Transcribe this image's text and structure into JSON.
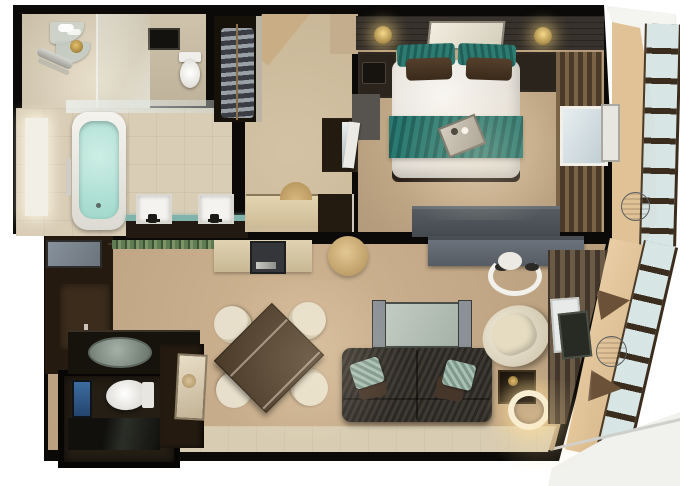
{
  "image_type": "3d-floorplan-render",
  "title_hidden": "",
  "palette": {
    "wall_black": "#0b0a08",
    "bathroom_floor": "#d9cdb6",
    "tub_water": "#b5e3d8",
    "vanity_glass_teal": "#7fb3ab",
    "entry_floor": "#c7b599",
    "bedroom_carpet": "#c2a98a",
    "living_carpet": "#c3a88a",
    "tile_floor": "#d8ccb2",
    "accent_teal": "#2a7a71",
    "dark_wood": "#241a10",
    "sofa_charcoal": "#33302b",
    "cream_upholstery": "#e7dfcb",
    "desk_gray": "#60666d",
    "balcony_deck": "#e6c89f",
    "railing_glass": "#d6e4e4",
    "lower_deck_white": "#f1f1ee"
  },
  "rooms": [
    {
      "label": "Bathroom",
      "furniture": [
        "shower with corner shelves",
        "shower wand",
        "toilet compartment",
        "ceiling vent",
        "bathtub with water",
        "shower screen",
        "double sink vanity",
        "teal glass counter edge"
      ]
    },
    {
      "label": "Entry and closet",
      "furniture": [
        "hanging closet rod with clothes",
        "entry carpet",
        "angled ceiling bulkhead",
        "wardrobe cabinet with mirror",
        "vanity counter",
        "half-round stool",
        "lower cabinet"
      ]
    },
    {
      "label": "Bedroom",
      "furniture": [
        "slatted headboard wall",
        "lit art panel",
        "wall sconce left",
        "wall sconce right",
        "nightstand with telephone",
        "nightstand right",
        "bed with white duvet",
        "teal bed runner",
        "teal pillows",
        "brown pillows",
        "breakfast tray",
        "gray cabinet",
        "open door leaf",
        "window to balcony",
        "brown drapes",
        "dresser"
      ]
    },
    {
      "label": "Living room",
      "furniture": [
        "kitchenette counter",
        "utensil rail",
        "mosaic backsplash",
        "tv wall panel",
        "console with coffee machine",
        "round pouf",
        "dining table",
        "dining chair",
        "dining chair",
        "dining chair",
        "dining chair",
        "desk",
        "desk chair",
        "glass coffee table",
        "chevron sofa",
        "teal accent pillows",
        "brown accent pillows",
        "swivel tub chair",
        "side table",
        "ring lamp",
        "guest toilet room",
        "framed blue art",
        "bar credenza with art panel",
        "round glass tray",
        "window with drapes",
        "tile walkway"
      ]
    },
    {
      "label": "Balcony",
      "furniture": [
        "teak deck",
        "glass railing with dark rungs",
        "round bistro table",
        "wedge lounge chair",
        "wedge lounge chair",
        "round side table",
        "white awning",
        "lower white deck"
      ]
    }
  ]
}
